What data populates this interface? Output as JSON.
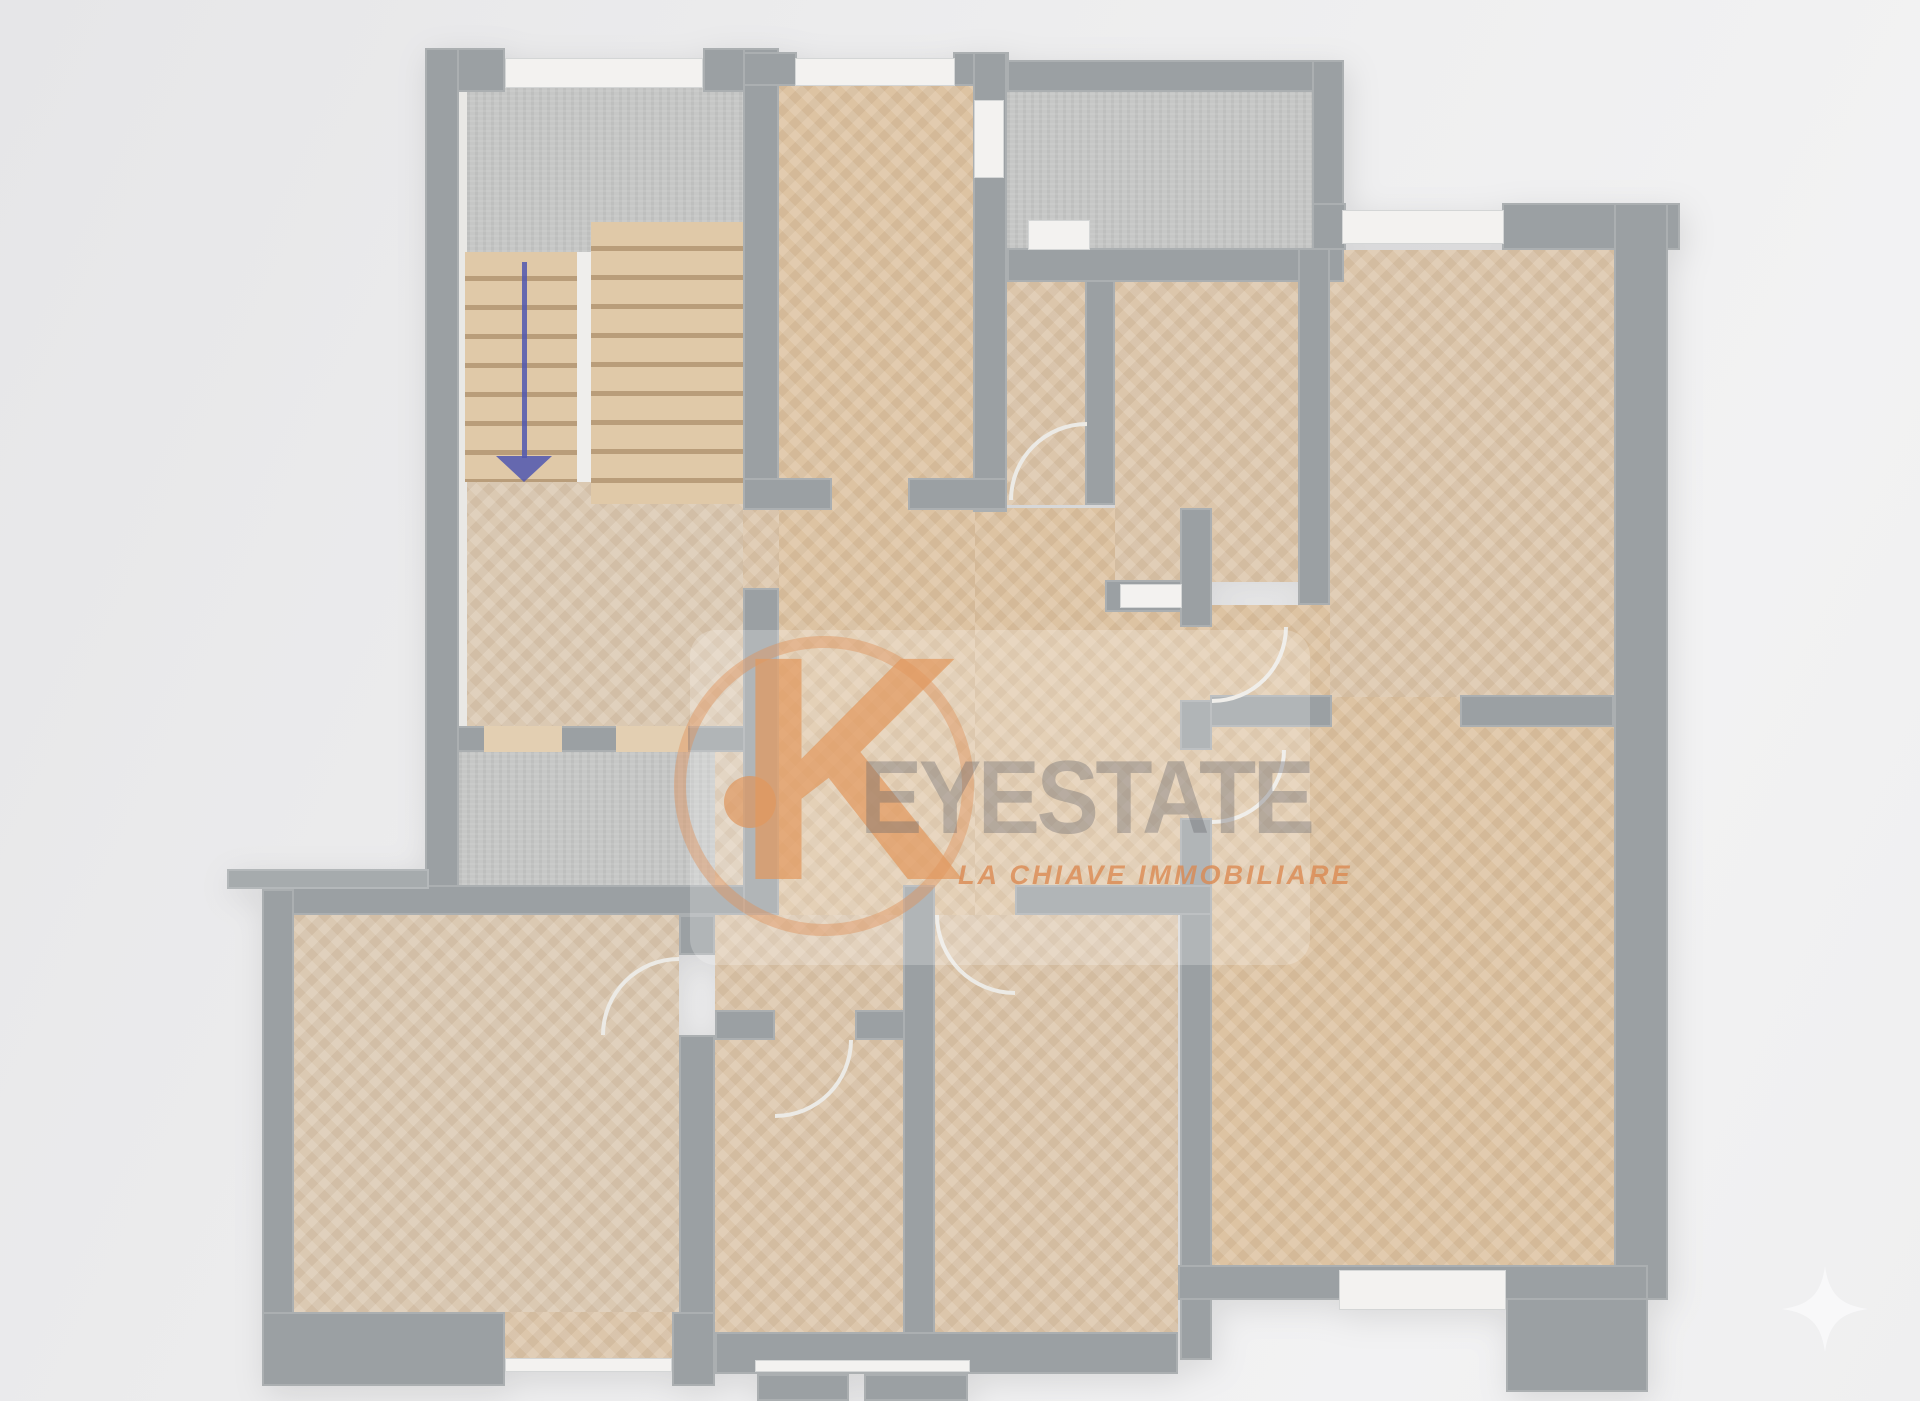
{
  "scene": {
    "type": "real-estate-floor-plan-render",
    "view": "top-down 3d render, herringbone parquet floors, gray walls, two concrete balconies, staircase with down direction arrow"
  },
  "watermark": {
    "brand": "KEYESTATE",
    "k_letter": "K",
    "wordmark": "EYESTATE",
    "tagline": "LA CHIAVE IMMOBILIARE"
  },
  "icons": {
    "stairs_direction": "down-arrow-icon",
    "background_decoration": "sparkle-icon"
  },
  "colors": {
    "background": "#ededee",
    "wall": "#9ba0a3",
    "floor_parquet": "#dcc6ab",
    "concrete": "#c6c7c6",
    "window_sill": "#f3f2f0",
    "watermark_orange": "#df9a62",
    "watermark_gray": "#69696e",
    "arrow_blue": "#4f57b0"
  }
}
